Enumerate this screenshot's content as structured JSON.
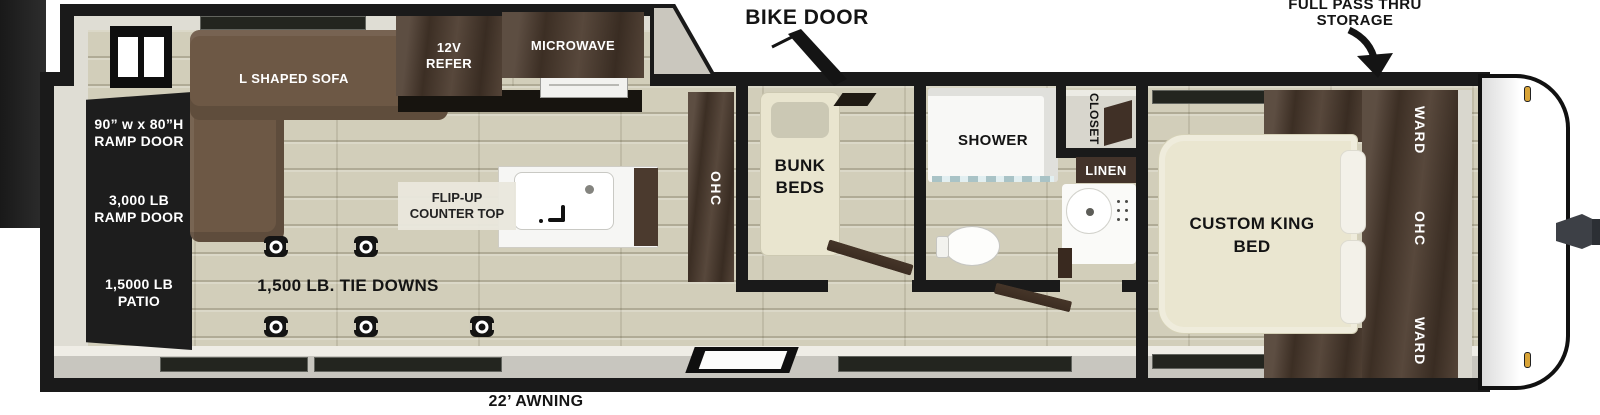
{
  "labels": {
    "bike_door": "BIKE DOOR",
    "storage1": "FULL PASS THRU",
    "storage2": "STORAGE",
    "awning": "22’ AWNING",
    "tie_downs": "1,500 LB. TIE DOWNS"
  },
  "ramp": {
    "size1": "90” w x 80”H",
    "size2": "RAMP DOOR",
    "weight1": "3,000 LB",
    "weight2": "RAMP DOOR",
    "patio1": "1,5000 LB",
    "patio2": "PATIO"
  },
  "garage": {
    "sofa": "L SHAPED SOFA",
    "refer1": "12V",
    "refer2": "REFER",
    "microwave": "MICROWAVE",
    "counter1": "FLIP-UP",
    "counter2": "COUNTER TOP",
    "ohc": "OHC"
  },
  "bunk": {
    "line1": "BUNK",
    "line2": "BEDS"
  },
  "bath": {
    "shower": "SHOWER",
    "closet": "CLOSET",
    "linen": "LINEN"
  },
  "bedroom": {
    "bed1": "CUSTOM KING",
    "bed2": "BED",
    "ward_top": "WARD",
    "ohc": "OHC",
    "ward_bottom": "WARD"
  },
  "icons": {
    "tie_down": "anchor-ring-plate",
    "bike_door_pointer": "diagonal-arrow",
    "storage_arrow": "curved-arrow-down",
    "sink": "basin-with-faucet",
    "toilet": "toilet-top-view",
    "hitch": "trailer-tongue-jack"
  },
  "colors": {
    "outline": "#1a1a1a",
    "cabinet_wood": "#4b3a2d",
    "sofa": "#6d5845",
    "floor": "#d2ceba",
    "mattress": "#eae6d0",
    "marker_light": "#d9a437"
  }
}
